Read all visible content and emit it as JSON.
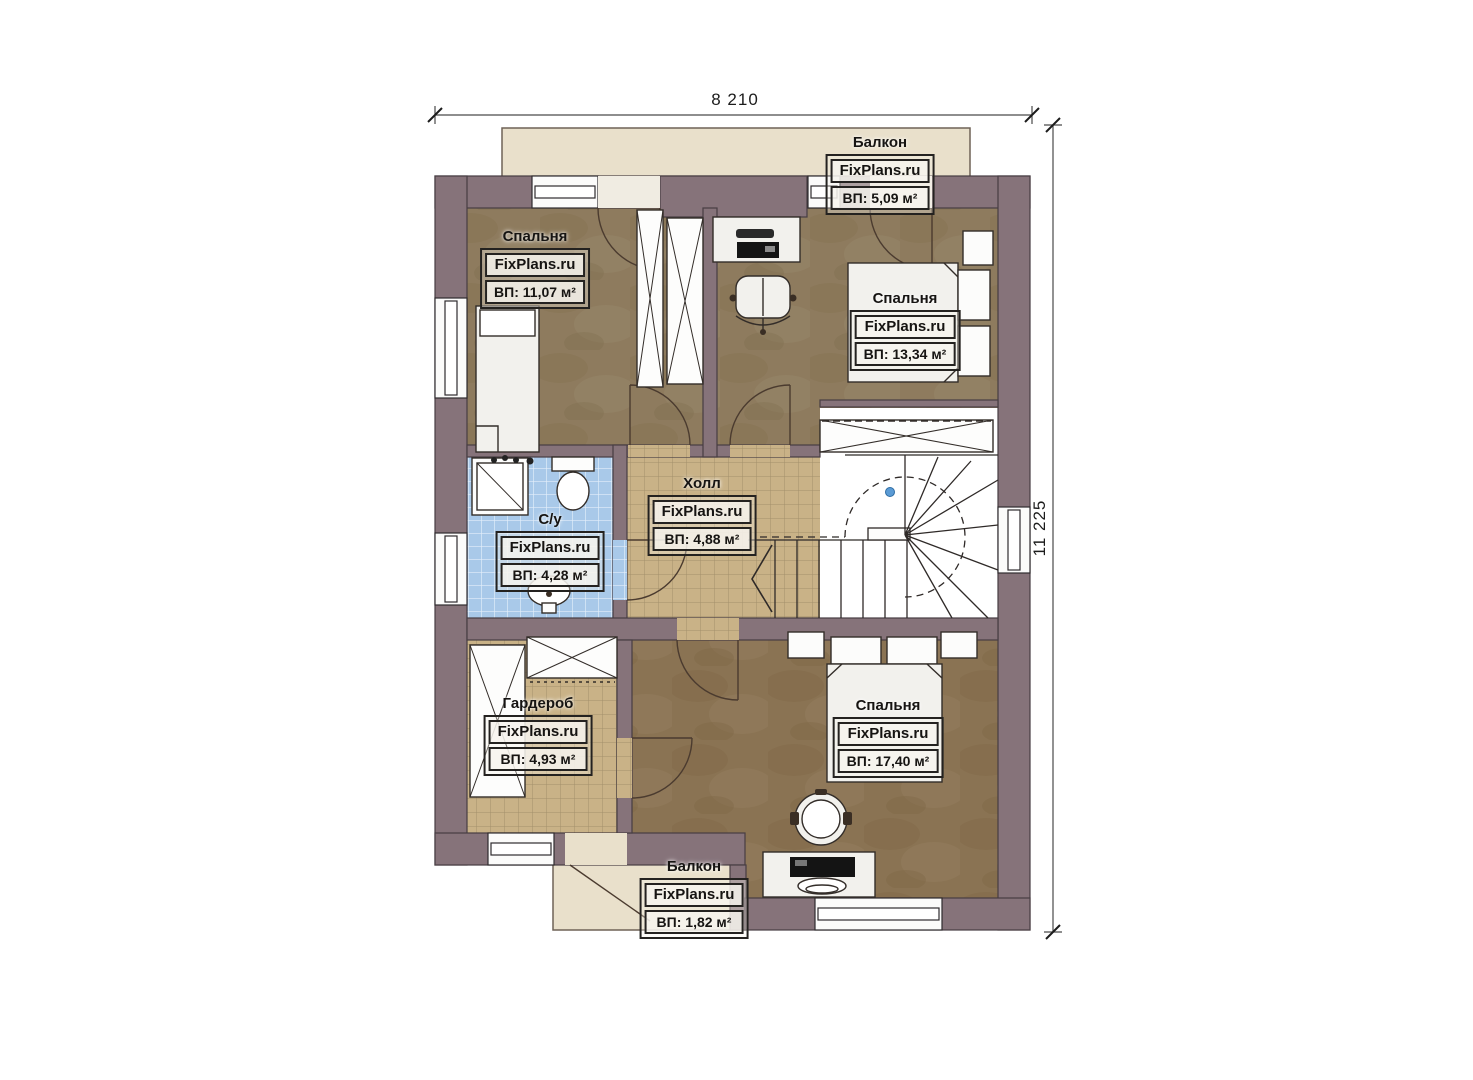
{
  "dimensions": {
    "width_label": "8 210",
    "height_label": "11 225"
  },
  "rooms": [
    {
      "id": "balcony-top",
      "name": "Балкон",
      "watermark": "FixPlans.ru",
      "area": "ВП: 5,09 м²"
    },
    {
      "id": "bedroom-1",
      "name": "Спальня",
      "watermark": "FixPlans.ru",
      "area": "ВП: 11,07 м²"
    },
    {
      "id": "bedroom-2",
      "name": "Спальня",
      "watermark": "FixPlans.ru",
      "area": "ВП: 13,34 м²"
    },
    {
      "id": "bathroom",
      "name": "С/у",
      "watermark": "FixPlans.ru",
      "area": "ВП: 4,28 м²"
    },
    {
      "id": "hall",
      "name": "Холл",
      "watermark": "FixPlans.ru",
      "area": "ВП: 4,88 м²"
    },
    {
      "id": "wardrobe",
      "name": "Гардероб",
      "watermark": "FixPlans.ru",
      "area": "ВП: 4,93 м²"
    },
    {
      "id": "bedroom-3",
      "name": "Спальня",
      "watermark": "FixPlans.ru",
      "area": "ВП: 17,40 м²"
    },
    {
      "id": "balcony-bottom",
      "name": "Балкон",
      "watermark": "FixPlans.ru",
      "area": "ВП: 1,82 м²"
    }
  ],
  "colors": {
    "wall": "#86737a",
    "floor_wood": "#8e7b5e",
    "floor_wood_dark": "#8a7353",
    "tile_tan": "#c9b287",
    "tile_blue": "#a9c9e9",
    "balcony": "#e9e0cb"
  }
}
